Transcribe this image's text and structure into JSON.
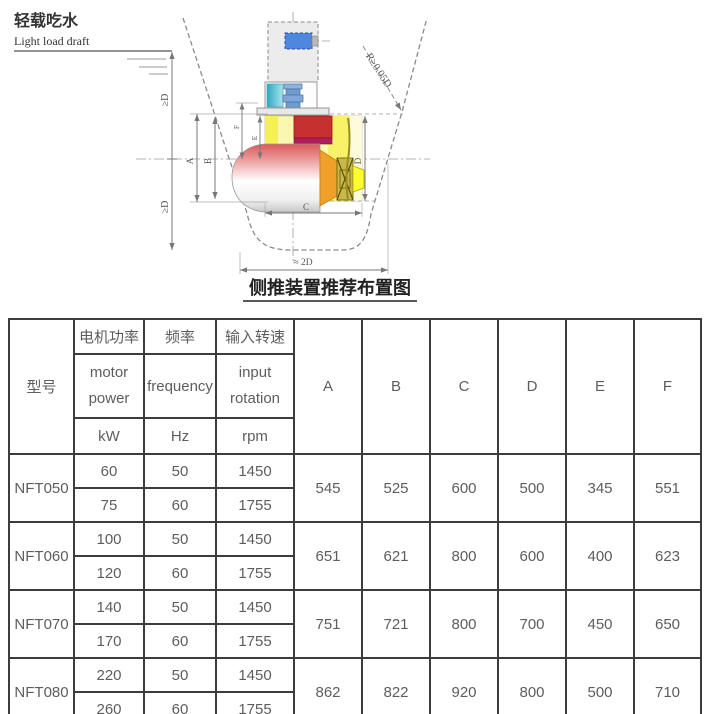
{
  "diagram": {
    "draft_label_cn": "轻载吃水",
    "draft_label_en": "Light load draft",
    "radius_label": "R≥0.05D",
    "ge_d_upper": "≥D",
    "ge_d_lower": "≥D",
    "approx_2d_label": "≈ 2D",
    "dim_a": "A",
    "dim_b": "B",
    "dim_c": "C",
    "dim_d": "D",
    "dim_e": "E",
    "dim_f": "F",
    "caption": "侧推装置推荐布置图"
  },
  "table": {
    "headers": {
      "model": "型号",
      "power_cn": "电机功率",
      "power_en1": "motor",
      "power_en2": "power",
      "power_unit": "kW",
      "freq_cn": "频率",
      "freq_en": "frequency",
      "freq_unit": "Hz",
      "rpm_cn": "输入转速",
      "rpm_en1": "input",
      "rpm_en2": "rotation",
      "rpm_unit": "rpm",
      "dims": [
        "A",
        "B",
        "C",
        "D",
        "E",
        "F"
      ]
    },
    "rows": [
      {
        "model": "NFT050",
        "variants": [
          [
            "60",
            "50",
            "1450"
          ],
          [
            "75",
            "60",
            "1755"
          ]
        ],
        "dims": [
          "545",
          "525",
          "600",
          "500",
          "345",
          "551"
        ]
      },
      {
        "model": "NFT060",
        "variants": [
          [
            "100",
            "50",
            "1450"
          ],
          [
            "120",
            "60",
            "1755"
          ]
        ],
        "dims": [
          "651",
          "621",
          "800",
          "600",
          "400",
          "623"
        ]
      },
      {
        "model": "NFT070",
        "variants": [
          [
            "140",
            "50",
            "1450"
          ],
          [
            "170",
            "60",
            "1755"
          ]
        ],
        "dims": [
          "751",
          "721",
          "800",
          "700",
          "450",
          "650"
        ]
      },
      {
        "model": "NFT080",
        "variants": [
          [
            "220",
            "50",
            "1450"
          ],
          [
            "260",
            "60",
            "1755"
          ]
        ],
        "dims": [
          "862",
          "822",
          "920",
          "800",
          "500",
          "710"
        ]
      }
    ]
  }
}
